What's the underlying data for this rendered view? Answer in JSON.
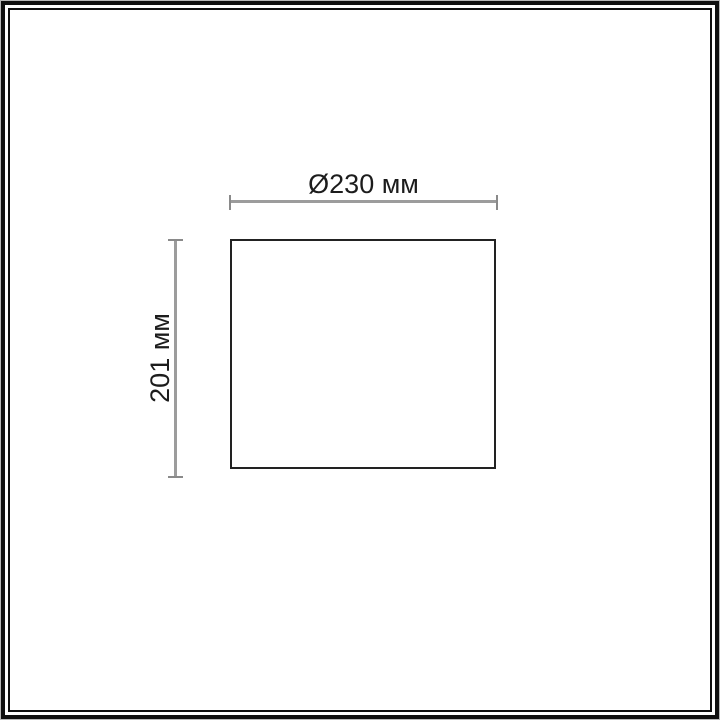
{
  "diagram": {
    "type": "product-dimension-drawing",
    "shape": "rectangle",
    "width_dimension": {
      "label": "Ø230 мм",
      "value": 230,
      "unit": "мм",
      "diameter_symbol": "Ø"
    },
    "height_dimension": {
      "label": "201 мм",
      "value": 201,
      "unit": "мм"
    }
  },
  "colors": {
    "background": "#ffffff",
    "frame": "#101010",
    "frame_edge": "#b8b8b8",
    "shape_outline": "#222222",
    "dimension_line": "#9c9c9c",
    "dimension_tick": "#8a8a8a",
    "text": "#1c1c1c"
  }
}
